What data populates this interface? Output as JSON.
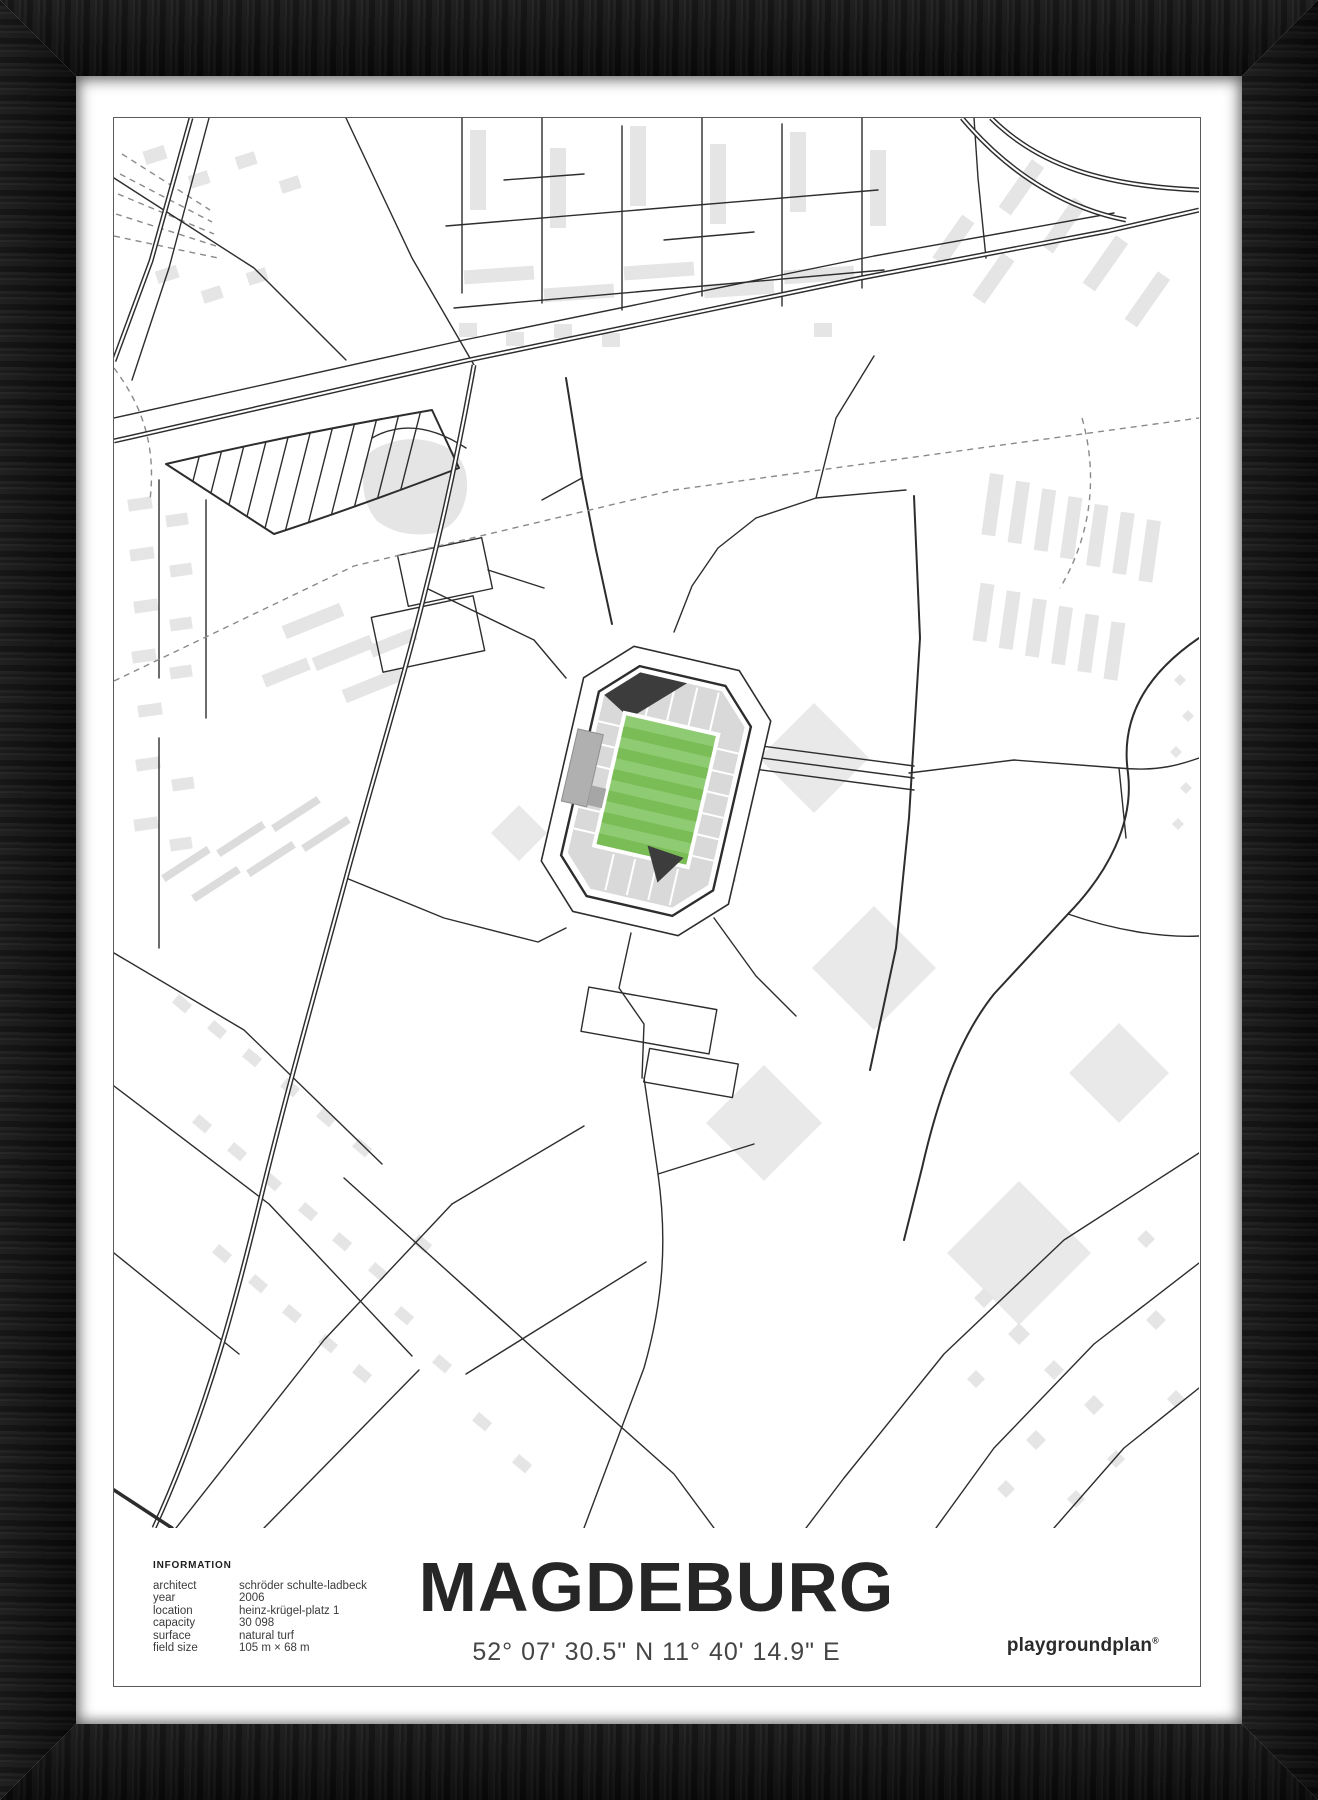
{
  "poster": {
    "title": "MAGDEBURG",
    "coordinates": "52° 07' 30.5\" N 11° 40' 14.9\" E",
    "brand": {
      "name": "playgroundplan",
      "registered_mark": "®"
    },
    "information": {
      "header": "INFORMATION",
      "rows": [
        {
          "label": "architect",
          "value": "schröder schulte-ladbeck"
        },
        {
          "label": "year",
          "value": "2006"
        },
        {
          "label": "location",
          "value": "heinz-krügel-platz 1"
        },
        {
          "label": "capacity",
          "value": "30 098"
        },
        {
          "label": "surface",
          "value": "natural turf"
        },
        {
          "label": "field size",
          "value": "105 m × 68 m"
        }
      ]
    }
  },
  "colors": {
    "frame": "#141414",
    "mat": "#ffffff",
    "line": "#2d2d2d",
    "bld": "#e5e5e5",
    "bld2": "#e9e9e9",
    "stand": "#d9d9d9",
    "pitchA": "#8fcb72",
    "pitchB": "#7abc55",
    "wedge": "#3c3c3c",
    "ink": "#262626",
    "inkSoft": "#454545",
    "dash": "#8a8a8a",
    "border": "#5a5a5a"
  }
}
